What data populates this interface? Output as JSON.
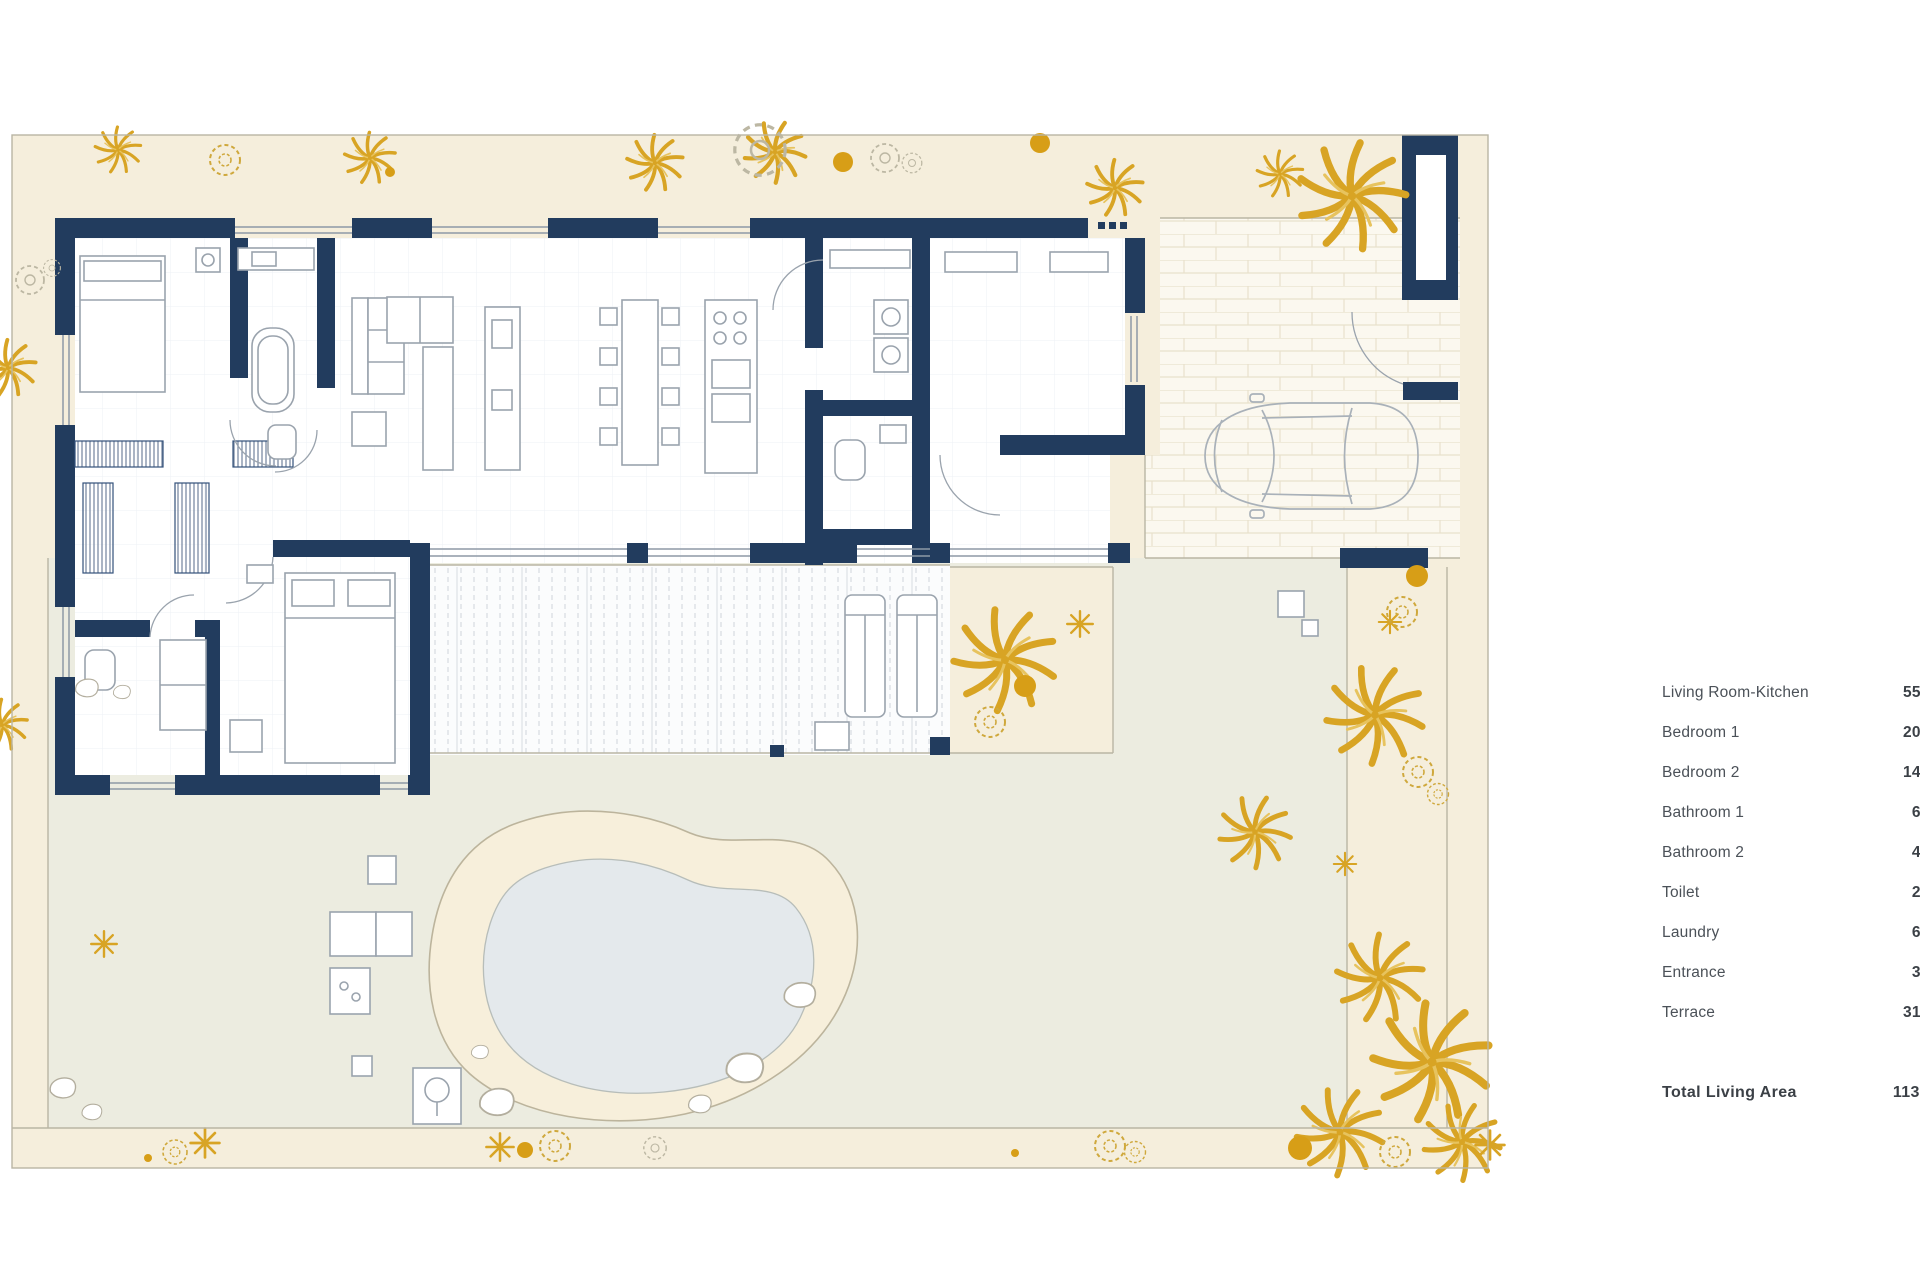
{
  "document": {
    "type": "villa-floor-plan",
    "background": "#ffffff"
  },
  "colors": {
    "wall": "#223c5e",
    "garden": "#f5eedc",
    "lawn": "#ecece0",
    "deckring": "#f7efdb",
    "water": "#e4e9ec",
    "palm": "#d8a424",
    "palmlight": "#e7c35e",
    "dot": "#d79e17",
    "outline": "#b9b5a4",
    "furniture": "#9aa3ad",
    "brickbg": "#fbf8ef",
    "brickline": "#e8e1cc",
    "text": "#4b5158",
    "textdark": "#3b4046"
  },
  "legend": {
    "rows": [
      {
        "label": "Living Room-Kitchen",
        "value": "55,7"
      },
      {
        "label": "Bedroom 1",
        "value": "20,2"
      },
      {
        "label": "Bedroom  2",
        "value": "14,7"
      },
      {
        "label": "Bathroom 1",
        "value": "6,0"
      },
      {
        "label": "Bathroom 2",
        "value": "4,6"
      },
      {
        "label": "Toilet",
        "value": "2,2"
      },
      {
        "label": "Laundry",
        "value": "6,7"
      },
      {
        "label": "Entrance",
        "value": "3,0"
      },
      {
        "label": "Terrace",
        "value": "31,9"
      }
    ],
    "total": {
      "label": "Total Living Area",
      "value": "113,6"
    }
  }
}
